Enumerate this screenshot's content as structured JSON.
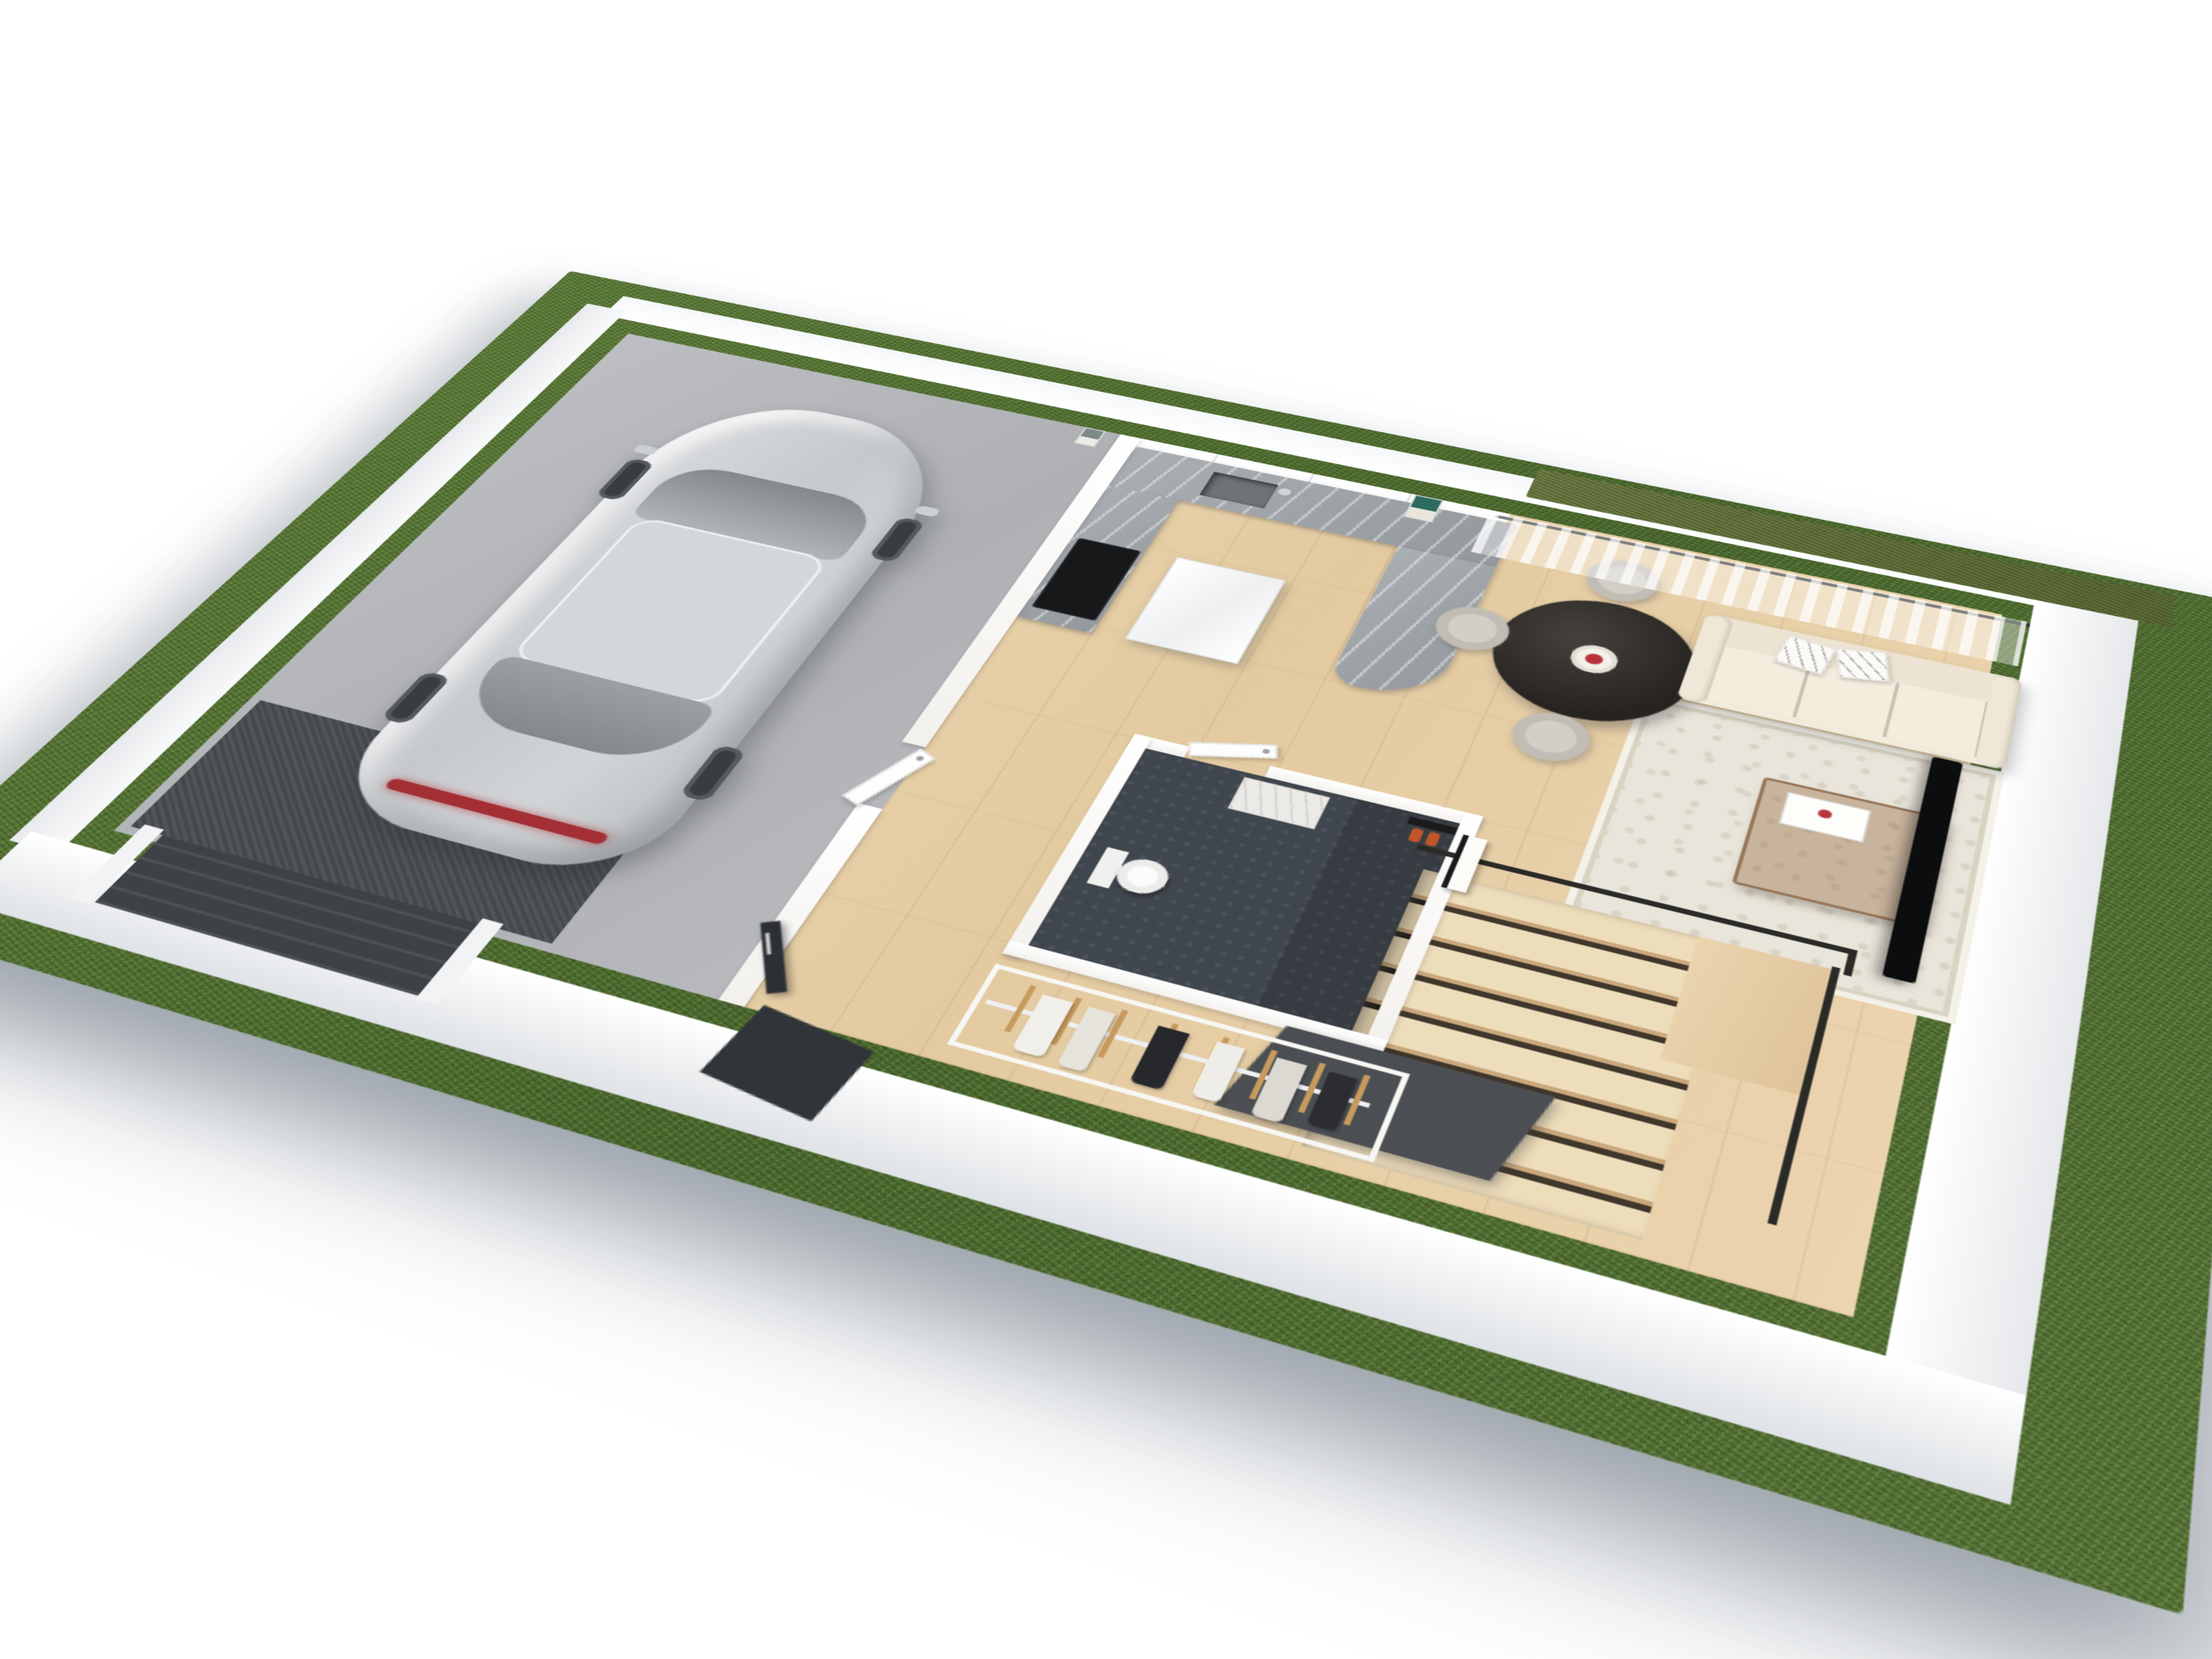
{
  "scene": {
    "title": "3D floor plan render — ground floor",
    "description": "Isometric cutaway 3D render of a house ground floor on a green grass plot",
    "text_content": "none (image contains no visible text)"
  },
  "palette": {
    "grass1": "#5d7c3a",
    "grass2": "#4b692e",
    "grass3": "#587538",
    "hedge": "#6e7c45",
    "wood1": "#eeddbb",
    "wood2": "#e3caa0",
    "wood3": "#ebd4ae",
    "marble1": "#aaafb3",
    "marble2": "#93989d",
    "garagedark": "#45484b",
    "gdoor": "#3e4246",
    "door": "#2c2f33",
    "tabledark": "#262320",
    "chair": "#d2cfc6",
    "sofa": "#f2ebdc",
    "rug": "#e9e5da",
    "tv": "#0c0d0e",
    "rail": "#2a2a27",
    "tile": "#40464d",
    "panel": "#4b4f53",
    "berry": "#b8323a",
    "bottle": "#c2552a",
    "hanger": "#c79a5e",
    "tail": "#a32f35",
    "art": "#2c6b5f",
    "wallTop": "#ffffff",
    "carBody": "#c9ccce"
  },
  "rooms": [
    {
      "id": "garage",
      "label": "Garage with parked silver SUV"
    },
    {
      "id": "kitchen",
      "label": "Kitchen with gray marble L-shaped counter"
    },
    {
      "id": "dining",
      "label": "Dining area with round black table and 4 chairs"
    },
    {
      "id": "living",
      "label": "Living room with cream sofa, rug, coffee table and TV"
    },
    {
      "id": "hallway",
      "label": "Hallway with open wardrobe rack"
    },
    {
      "id": "bathroom",
      "label": "Bathroom with toilet, vanity and shower"
    },
    {
      "id": "stairs",
      "label": "Staircase with black metal railing"
    },
    {
      "id": "yard",
      "label": "Grass plot surrounding the house"
    }
  ],
  "objects": {
    "car": "silver SUV coupe, nose toward kitchen wall, red tail light",
    "garage_door": "dark charcoal sectional door with horizontal slats",
    "front_door": "black entry door shown open with chrome pull",
    "kitchen": [
      "white upper cabinets",
      "marble countertop",
      "undermount sink with chrome faucet",
      "black induction hob",
      "glossy white fridge"
    ],
    "dining": [
      "round black pedestal table",
      "white fluted bowl with red berries",
      "4 light gray tub chairs",
      "teal framed wall art"
    ],
    "living": [
      "3-seat cream sofa",
      "2 white patterned throw pillows",
      "beige patterned area rug",
      "bronze glass coffee table with white tray",
      "black TV on side wall",
      "sheer white curtains",
      "black-framed sliding glass wall",
      "green hedge outside window"
    ],
    "bathroom": [
      "white toilet",
      "marble vanity block",
      "dark tiled floor",
      "black shower bar with orange bottles",
      "white towel on black rail",
      "white door with chrome handle"
    ],
    "hallway": [
      "open wardrobe rail with wooden hangers and hanging garments"
    ],
    "stairs": [
      "light oak treads",
      "thin black metal railings",
      "charcoal under-stair panel"
    ]
  },
  "counts": {
    "dining_chairs": 4,
    "throw_pillows": 2,
    "sofa_seats": 3,
    "hangers": 8,
    "garments": 6,
    "car_wheels_visible": 4
  }
}
